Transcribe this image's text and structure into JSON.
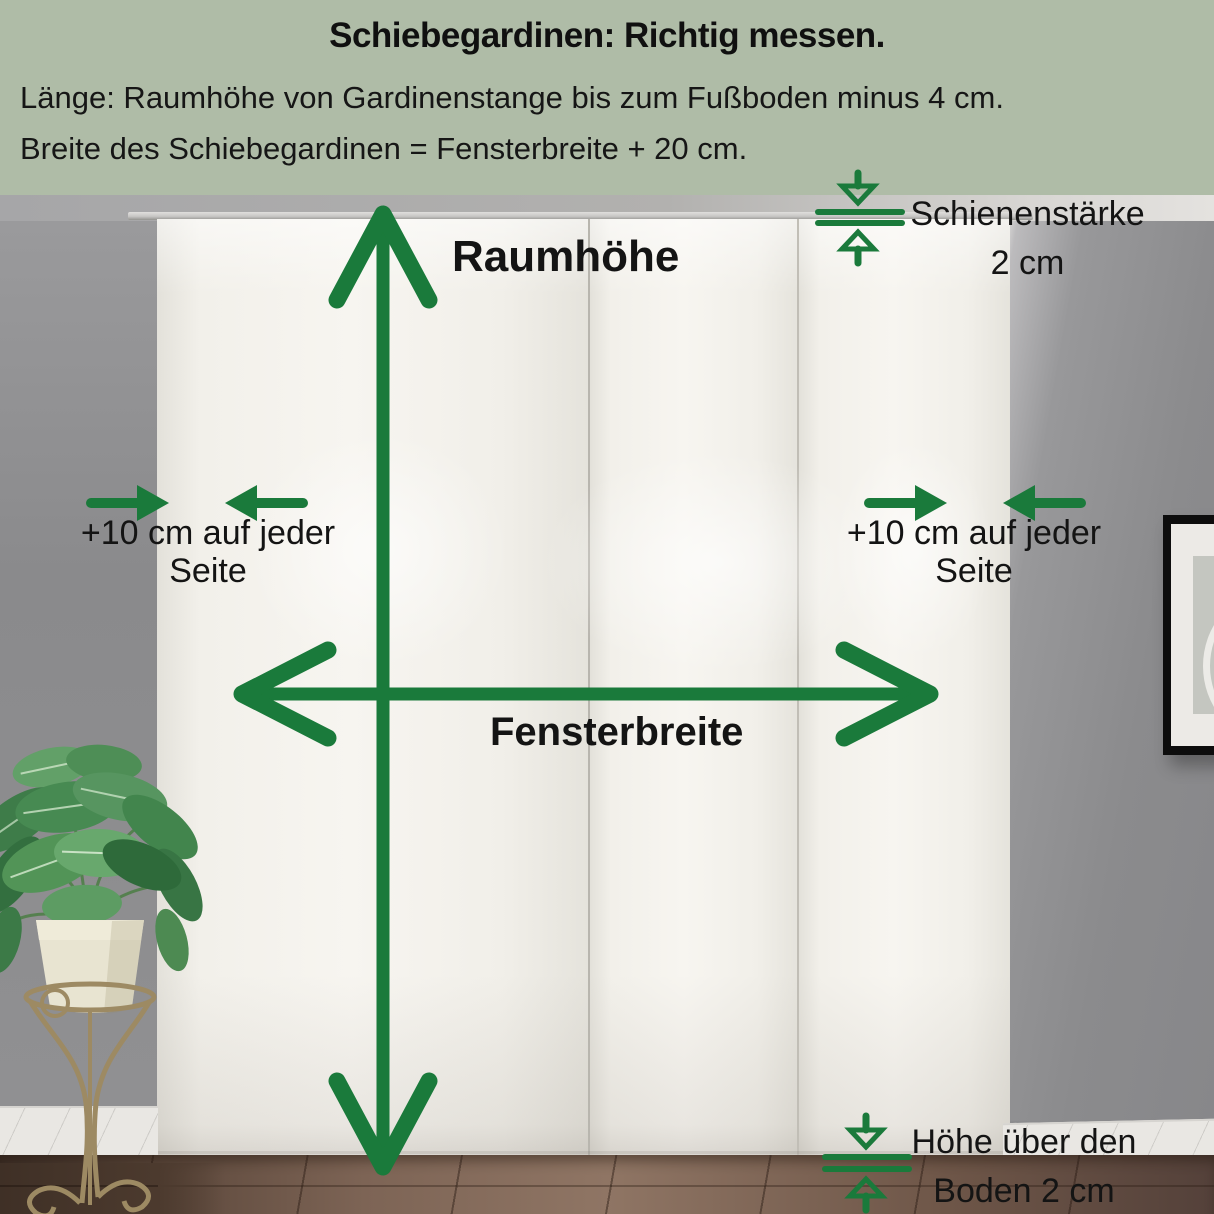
{
  "colors": {
    "accent_green": "#1a7a3b",
    "header_bg": "#afbca7",
    "label_text": "#141414"
  },
  "header": {
    "title": "Schiebegardinen: Richtig messen.",
    "line1": "Länge: Raumhöhe von Gardinenstange bis zum Fußboden minus 4 cm.",
    "line2": "Breite des Schiebegardinen = Fensterbreite + 20 cm."
  },
  "diagram": {
    "room_height": "Raumhöhe",
    "window_width": "Fensterbreite",
    "rail_thickness": {
      "line1": "Schienenstärke",
      "line2": "2 cm"
    },
    "side_left": {
      "line1": "+10 cm auf jeder",
      "line2": "Seite"
    },
    "side_right": {
      "line1": "+10 cm auf jeder",
      "line2": "Seite"
    },
    "floor_gap": {
      "line1": "Höhe über den",
      "line2": "Boden 2 cm"
    }
  }
}
